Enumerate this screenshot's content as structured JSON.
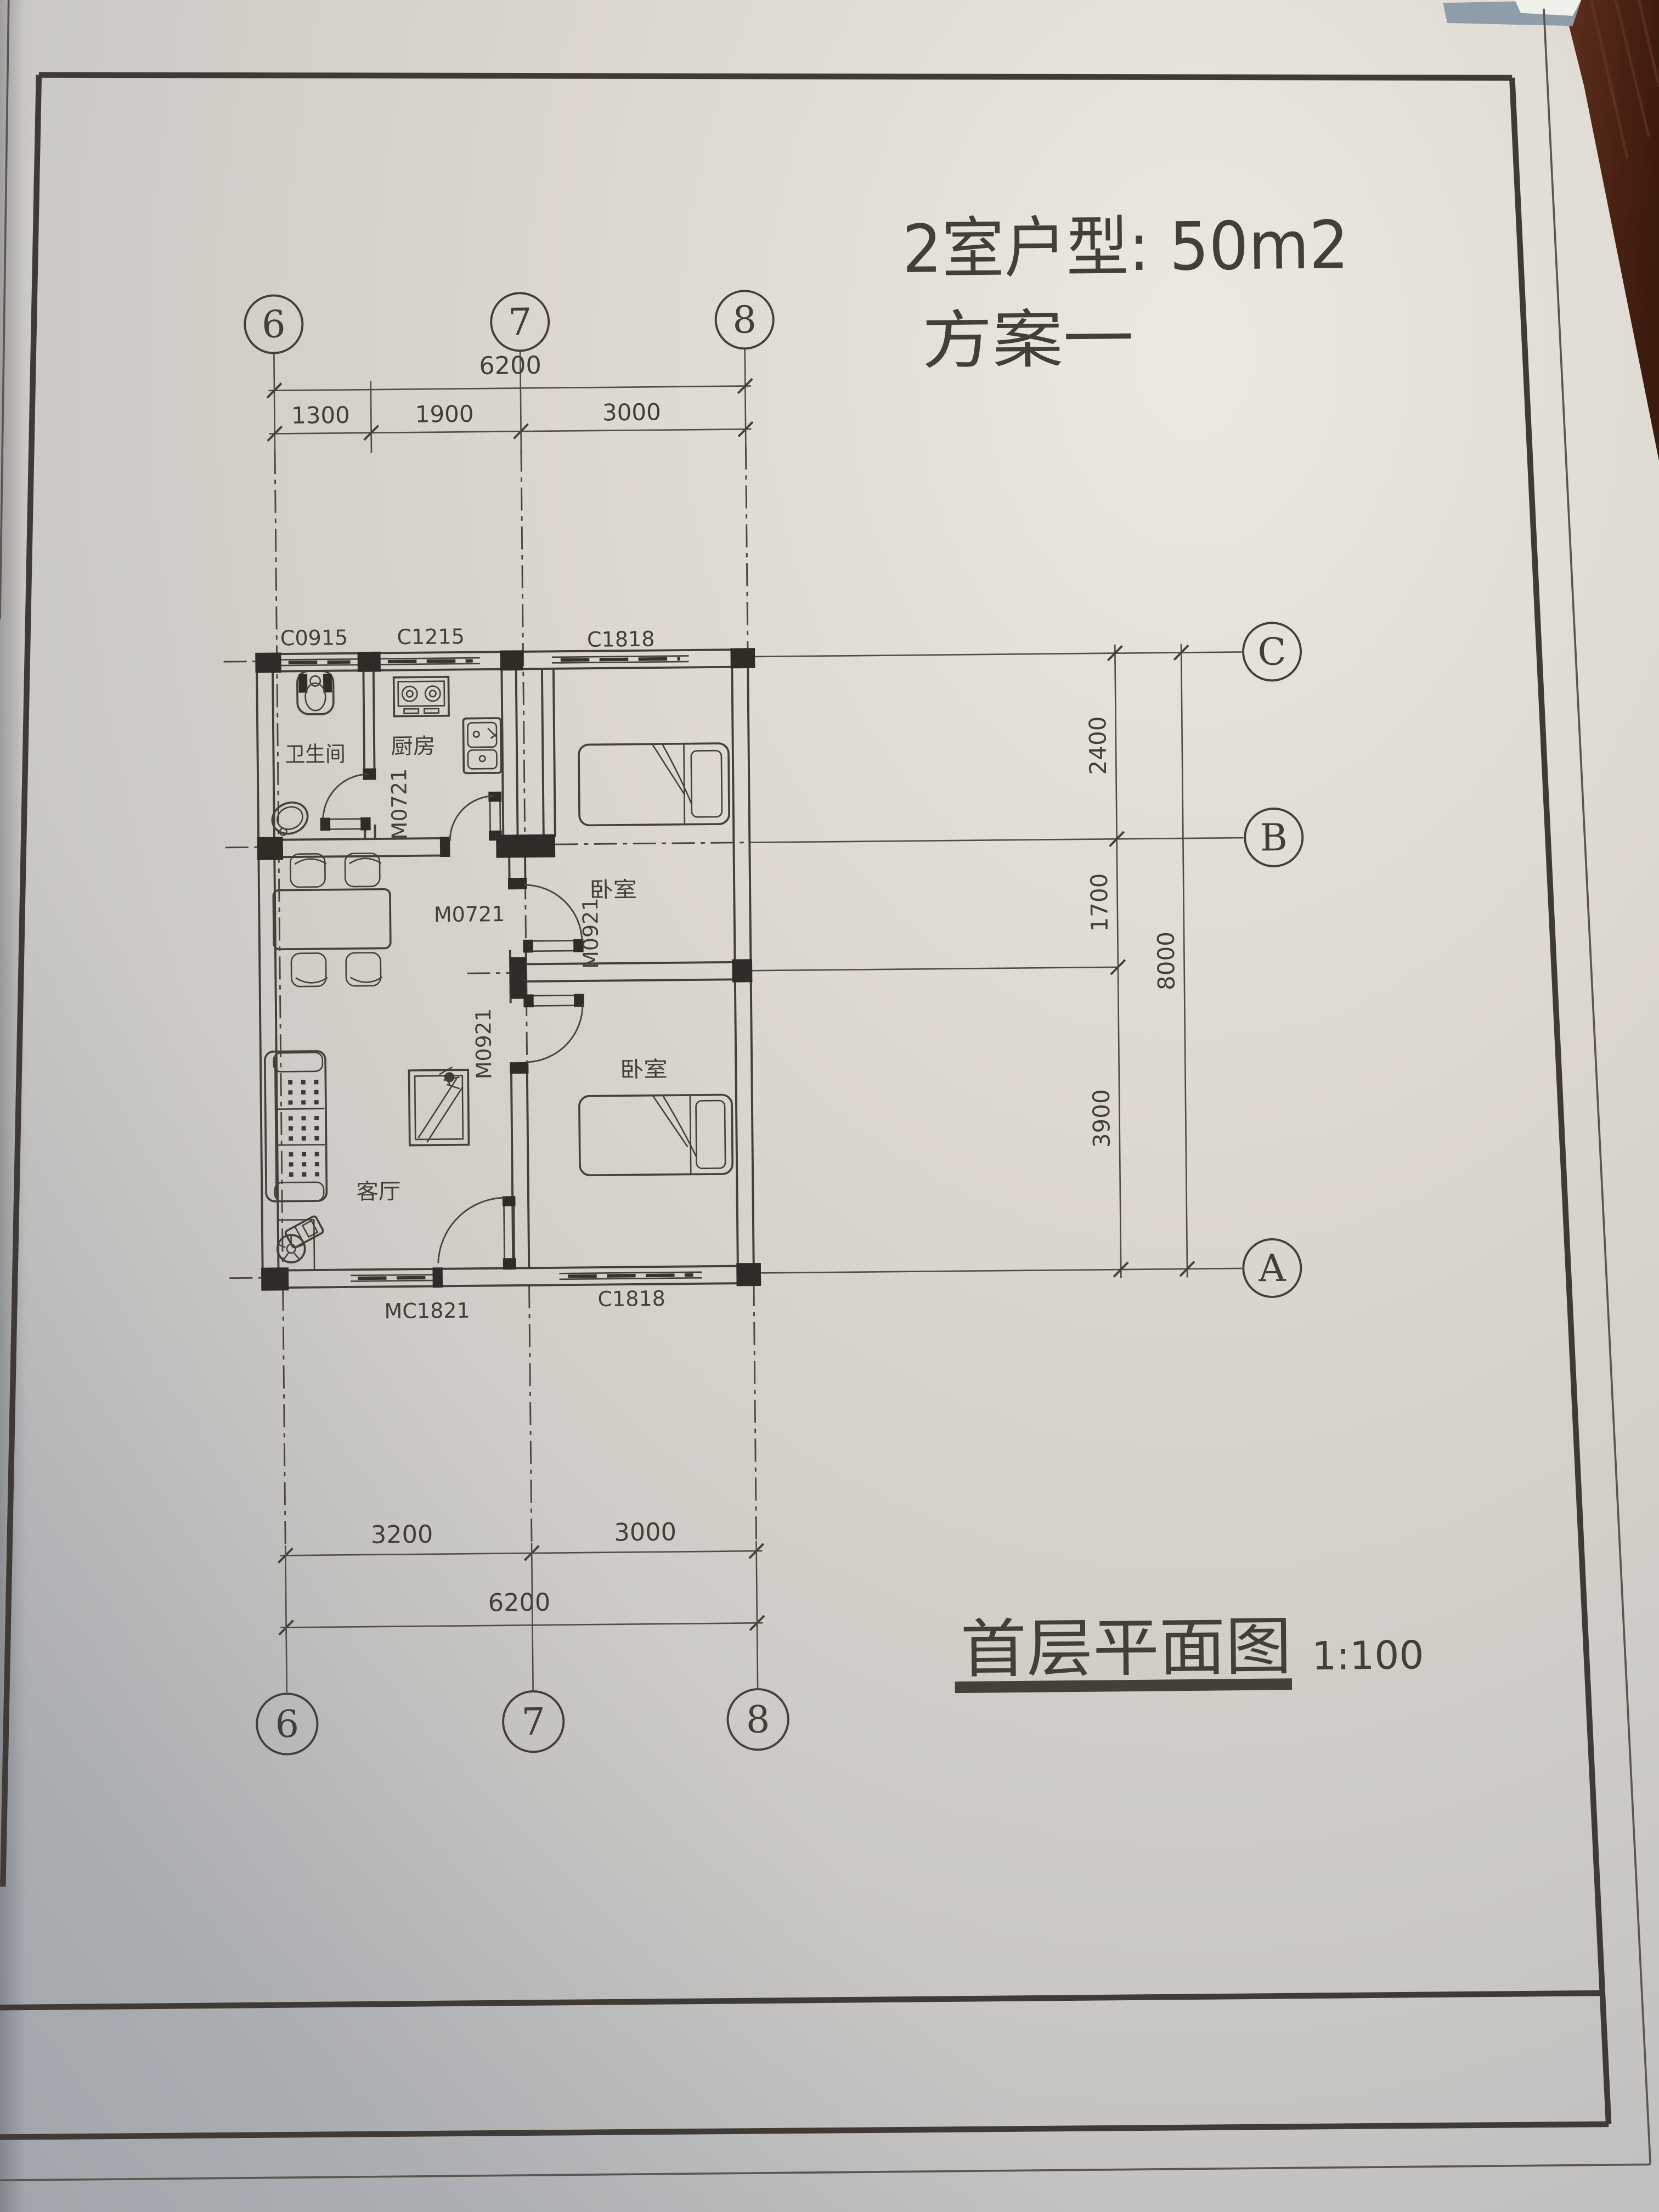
{
  "header": {
    "line1": "2室户型: 50m2",
    "line2": "方案一"
  },
  "title_block": {
    "name": "首层平面图",
    "scale": "1:100"
  },
  "axes": {
    "top": [
      "6",
      "7",
      "8"
    ],
    "bottom": [
      "6",
      "7",
      "8"
    ],
    "right": [
      "C",
      "B",
      "A"
    ]
  },
  "dims": {
    "top_overall": "6200",
    "top_segments": [
      "1300",
      "1900",
      "3000"
    ],
    "bottom_segments": [
      "3200",
      "3000"
    ],
    "bottom_overall": "6200",
    "right_segments": [
      "2400",
      "1700",
      "3900"
    ],
    "right_overall": "8000"
  },
  "rooms": {
    "bathroom": "卫生间",
    "kitchen": "厨房",
    "bedroom1": "卧室",
    "bedroom2": "卧室",
    "living": "客厅"
  },
  "openings": {
    "window_bath": "C0915",
    "window_kitchen": "C1215",
    "window_bedroom1": "C1818",
    "window_bedroom2": "C1818",
    "door_bath": "M0721",
    "door_kitchen": "M0721",
    "door_bedroom1": "M0921",
    "door_bedroom2": "M0921",
    "door_window_living": "MC1821"
  },
  "colors": {
    "paper": "#dcd7cf",
    "ink": "#443f39",
    "pier_black": "#2f2b27",
    "wood": "#54291a",
    "top_edge_blue": "#8f9dab"
  }
}
